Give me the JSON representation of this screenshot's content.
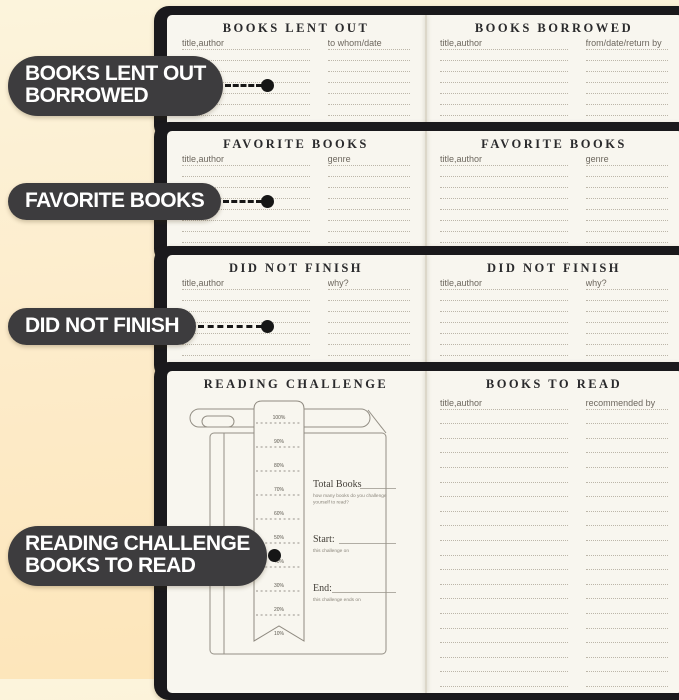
{
  "colors": {
    "background_top": "#fcf4dc",
    "background_bottom": "#fde5b8",
    "cover": "#1a191c",
    "page": "#f8f6ef",
    "rule_dotted": "#bcb6a9",
    "pill": "#3d3c3e",
    "pill_text": "#ffffff",
    "connector": "#161616"
  },
  "callouts": [
    {
      "lines": [
        "BOOKS LENT OUT",
        "BORROWED"
      ]
    },
    {
      "lines": [
        "FAVORITE BOOKS"
      ]
    },
    {
      "lines": [
        "DID NOT FINISH"
      ]
    },
    {
      "lines": [
        "READING CHALLENGE",
        "BOOKS TO READ"
      ]
    }
  ],
  "spreads": [
    {
      "left": {
        "title": "BOOKS LENT OUT",
        "col1": "title,author",
        "col2": "to whom/date",
        "lines": 7
      },
      "right": {
        "title": "BOOKS BORROWED",
        "col1": "title,author",
        "col2": "from/date/return by",
        "lines": 7
      }
    },
    {
      "left": {
        "title": "FAVORITE BOOKS",
        "col1": "title,author",
        "col2": "genre",
        "lines": 8
      },
      "right": {
        "title": "FAVORITE BOOKS",
        "col1": "title,author",
        "col2": "genre",
        "lines": 8
      }
    },
    {
      "left": {
        "title": "DID NOT FINISH",
        "col1": "title,author",
        "col2": "why?",
        "lines": 8
      },
      "right": {
        "title": "DID NOT FINISH",
        "col1": "title,author",
        "col2": "why?",
        "lines": 8
      }
    },
    {
      "left": {
        "title": "READING CHALLENGE"
      },
      "right": {
        "title": "BOOKS TO READ",
        "col1": "title,author",
        "col2": "recommended by",
        "lines": 20
      }
    }
  ],
  "reading_challenge": {
    "percent_labels": [
      "100%",
      "90%",
      "80%",
      "70%",
      "60%",
      "50%",
      "40%",
      "30%",
      "20%",
      "10%"
    ],
    "fields": [
      {
        "label": "Total Books",
        "note": "how many books do you challenge yourself to read?"
      },
      {
        "label": "Start:",
        "note": "this challenge on"
      },
      {
        "label": "End:",
        "note": "this challenge ends on"
      }
    ]
  }
}
